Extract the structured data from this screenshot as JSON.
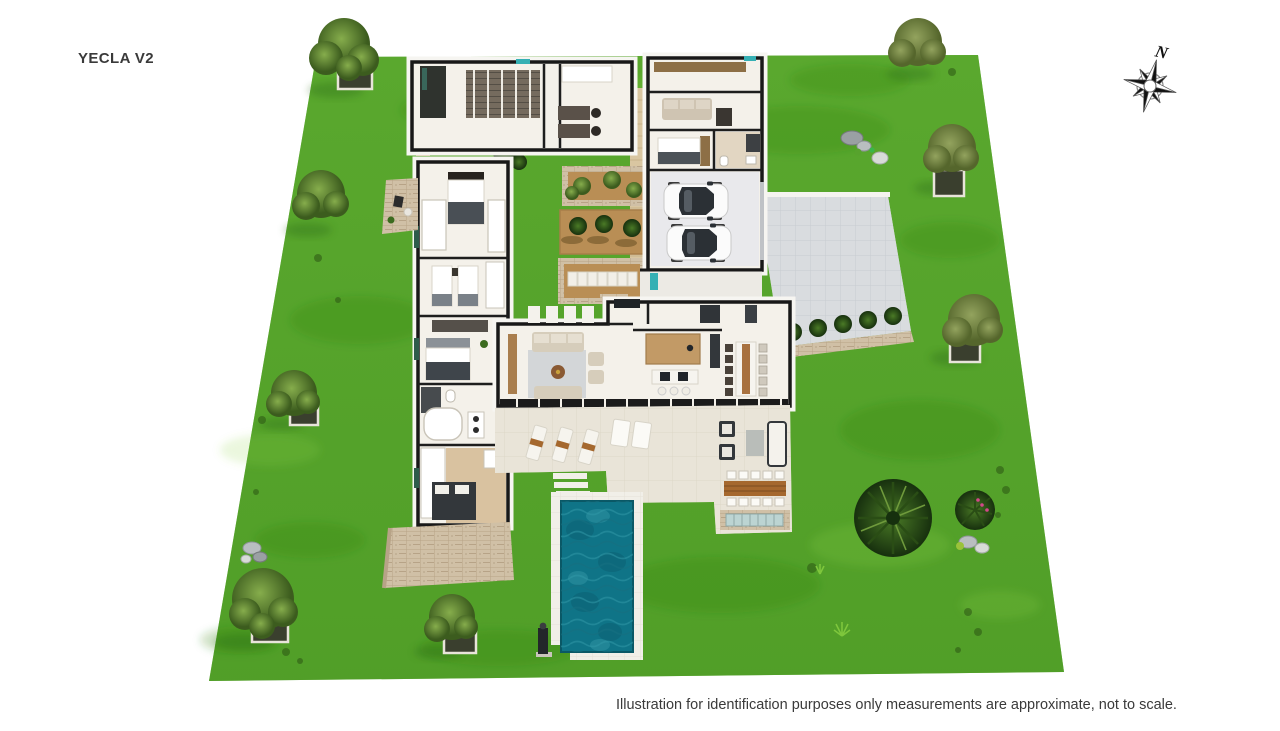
{
  "title": "YECLA V2",
  "caption": "Illustration for identification purposes only measurements are approximate, not to scale.",
  "compass": {
    "label": "N"
  },
  "palette": {
    "background": "#ffffff",
    "lawn": "#57a42b",
    "lawn_shade": "#2e7a12",
    "paving": "#d9dcdf",
    "terrace": "#e9e4d8",
    "pool_deck": "#f1efe8",
    "pool_water": "#0f7487",
    "stone": "#cdbb9f",
    "wall": "#1a1a1a",
    "floor": "#f4f1ea",
    "wood": "#c29a66",
    "teal_door": "#35b0b4"
  }
}
